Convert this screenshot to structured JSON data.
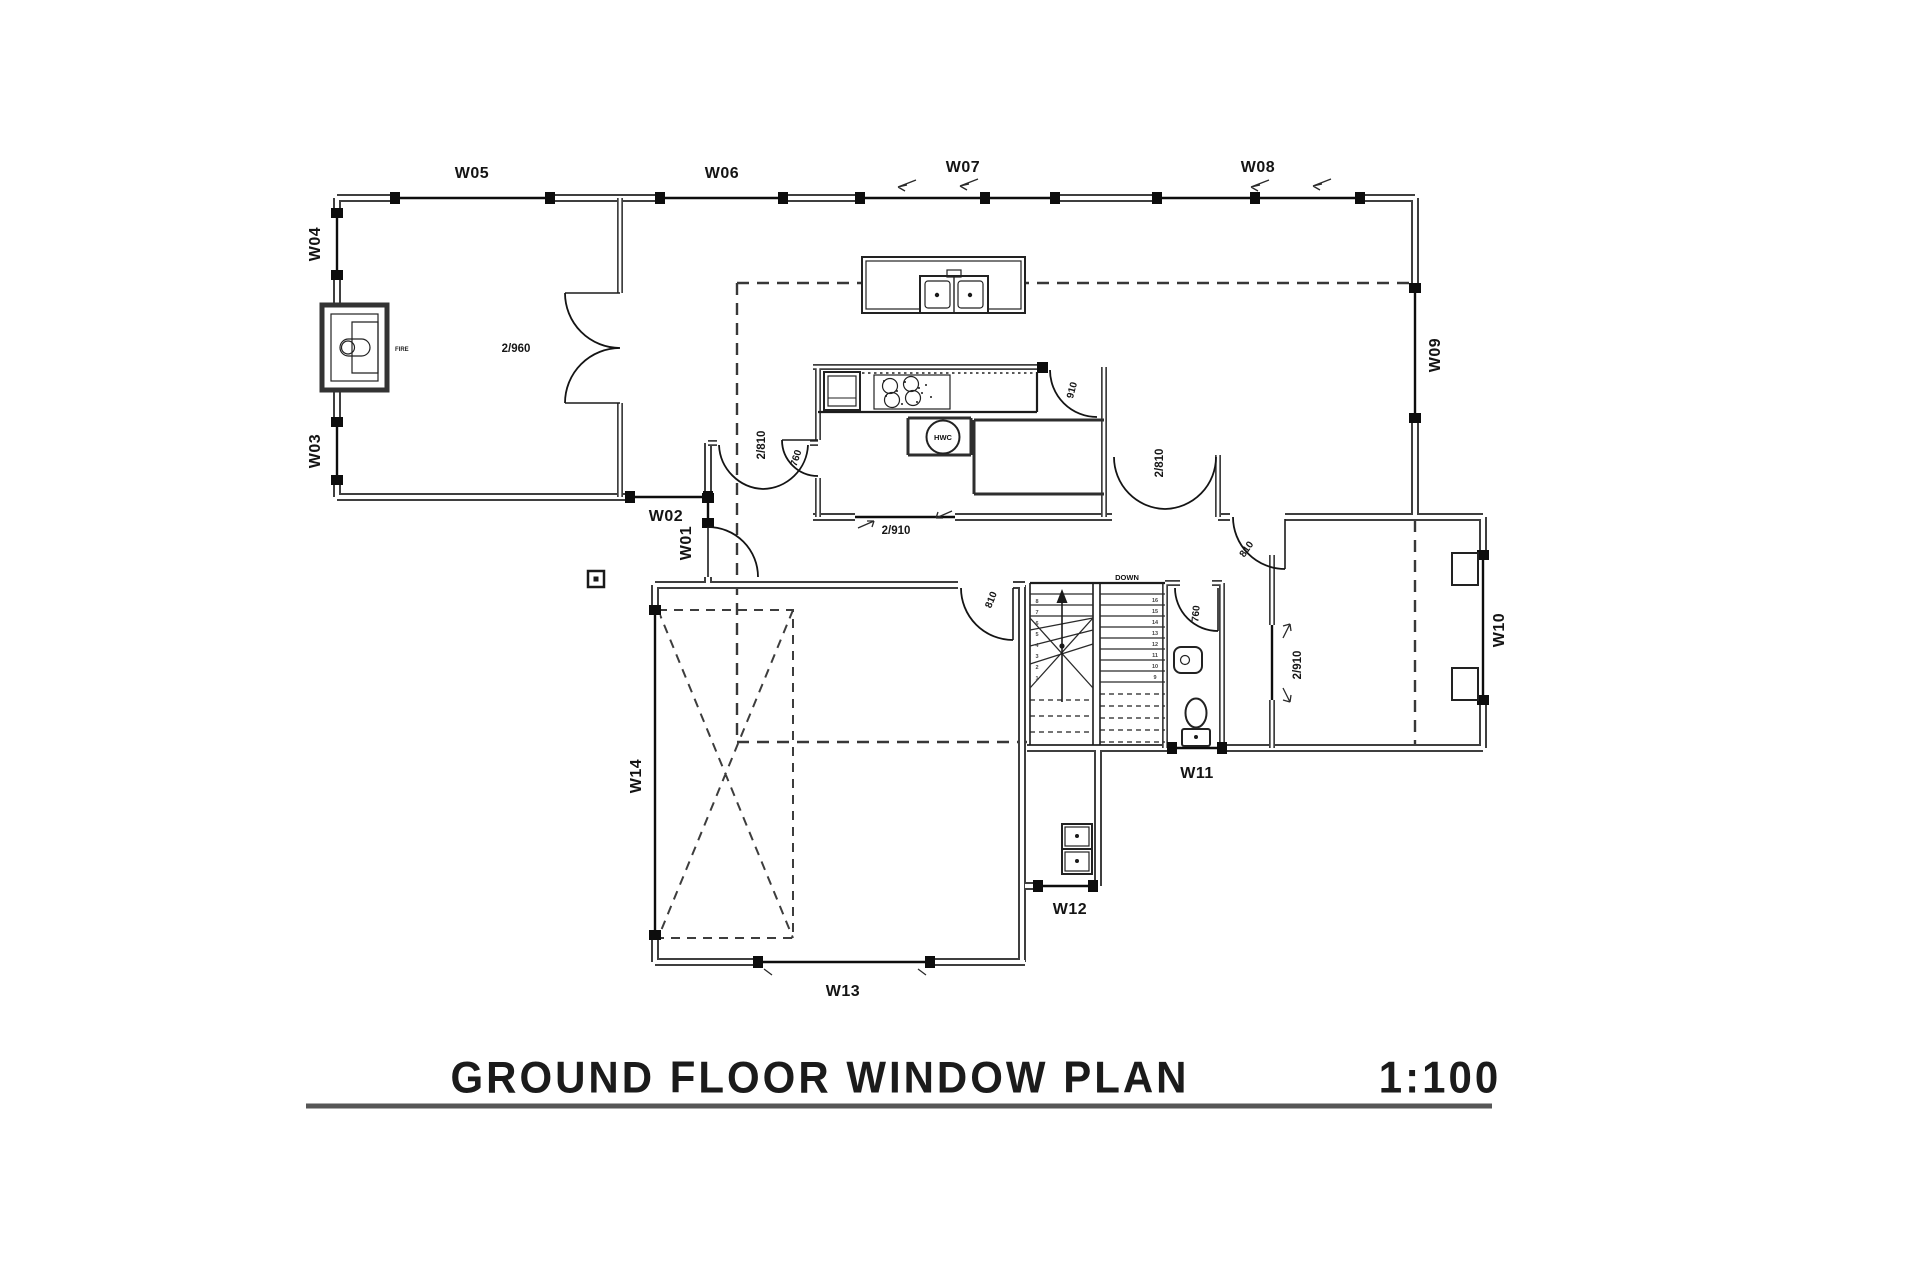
{
  "title": {
    "text": "GROUND FLOOR WINDOW PLAN",
    "scale": "1:100"
  },
  "windows": {
    "w01": "W01",
    "w02": "W02",
    "w03": "W03",
    "w04": "W04",
    "w05": "W05",
    "w06": "W06",
    "w07": "W07",
    "w08": "W08",
    "w09": "W09",
    "w10": "W10",
    "w11": "W11",
    "w12": "W12",
    "w13": "W13",
    "w14": "W14"
  },
  "doors": {
    "lounge_double": "2/960",
    "dining_double": "2/810",
    "pantry_door": "760",
    "kitchen_door": "910",
    "hall_slider": "2/910",
    "living_double": "2/810",
    "family_entry": "810",
    "family_slider": "2/910",
    "wc_door": "760",
    "garage_door": "810"
  },
  "stairs": {
    "down": "DOWN",
    "numbers_right": [
      "16",
      "15",
      "14",
      "13",
      "12",
      "11",
      "10",
      "9"
    ],
    "numbers_left": [
      "1",
      "2",
      "3",
      "4",
      "5",
      "6",
      "7",
      "8"
    ]
  },
  "fixtures": {
    "hot_water": "HWC",
    "fireplace": "FIRE"
  },
  "colors": {
    "wall": "#3f3f3f",
    "line": "#111111",
    "dash": "#3a3a3a",
    "background": "#ffffff"
  }
}
